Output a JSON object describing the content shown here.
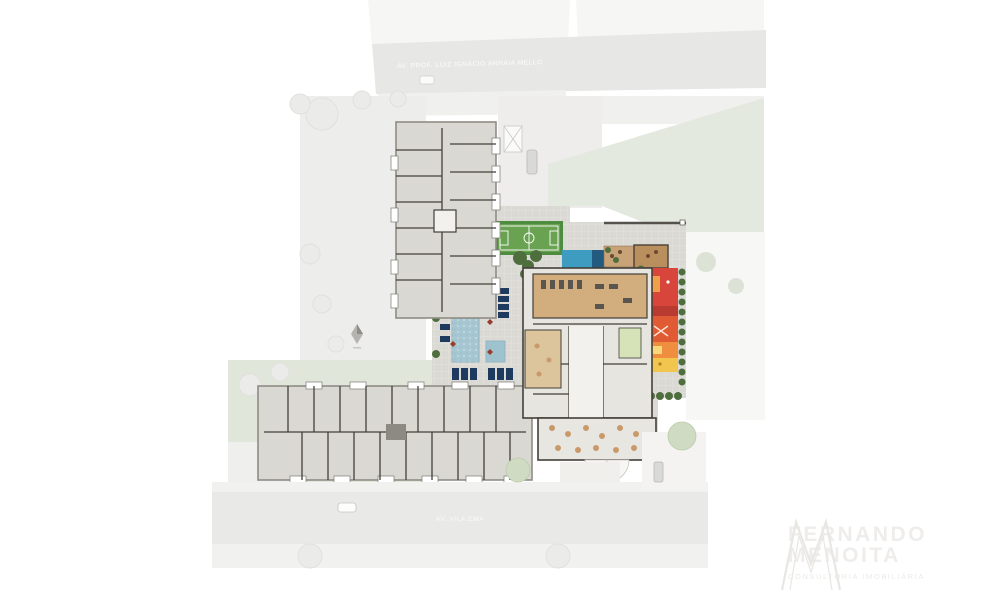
{
  "streets": {
    "top_label": "AV. PROF. LUIZ IGNÁCIO ANHAIA MELLO",
    "bottom_label": "AV. VILA EMA"
  },
  "watermark": {
    "name_line1": "FERNANDO",
    "name_line2": "MENOITA",
    "tagline": "CONSULTORIA IMOBILIÁRIA"
  },
  "colors": {
    "deck": "#dbd9d4",
    "deckGrid": "#e9e7e3",
    "pool": "#a6c7d2",
    "kidsPool": "#9fc2cf",
    "poolDark": "#1e3a5e",
    "spa": "#3d9cc0",
    "spaDark": "#235a80",
    "court": "#69a351",
    "courtDark": "#4e8c40",
    "wood": "#c8a377",
    "woodGym": "#d2ad7e",
    "woodLounge": "#dcc49c",
    "hedge": "#4f6e3e",
    "bushLight": "#7c9a62",
    "playRed": "#d8463b",
    "playDarkRed": "#b93a30",
    "playOrangeRed": "#e05a33",
    "playOrange": "#ef8e3e",
    "playYellow": "#f2c64e",
    "building": "#dad8d3",
    "wall": "#433f39",
    "garden": "#e1e6db",
    "greenSlope": "#e4e9e0",
    "paving": "#ededeb",
    "street": "#e9e9e7",
    "sidewalk": "#f1f1ef",
    "lot": "#f6f6f4",
    "parasol": "#973b2c",
    "table": "#c9996a",
    "treeSoft": "#cfdcc3",
    "car": "#d9d9d7",
    "watermark": "#eceae8"
  }
}
